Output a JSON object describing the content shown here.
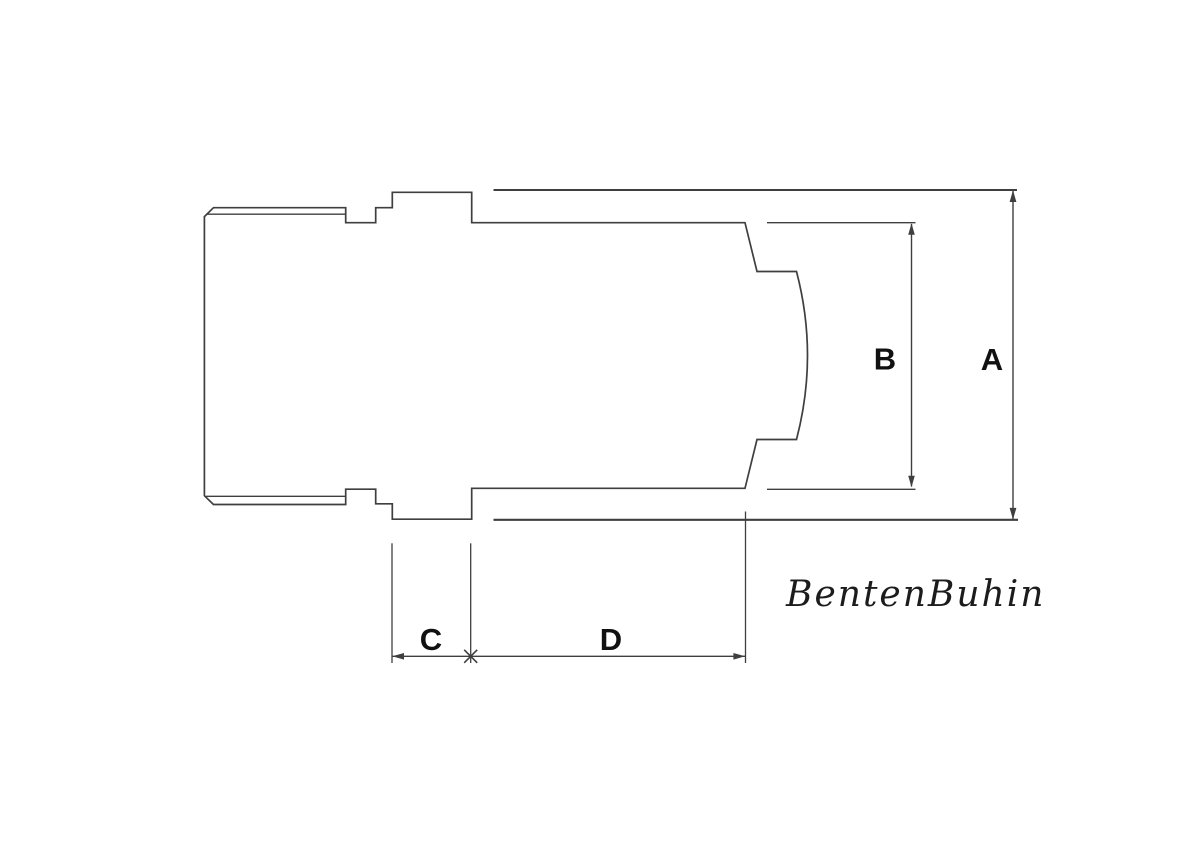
{
  "drawing": {
    "kind": "technical-dimension-drawing",
    "labels": {
      "a": "A",
      "b": "B",
      "c": "C",
      "d": "D"
    },
    "watermark": "BentenBuhin",
    "colors": {
      "line": "#3f3f3f",
      "text": "#111111",
      "brand": "#1c1c1c",
      "background": "#ffffff"
    }
  }
}
